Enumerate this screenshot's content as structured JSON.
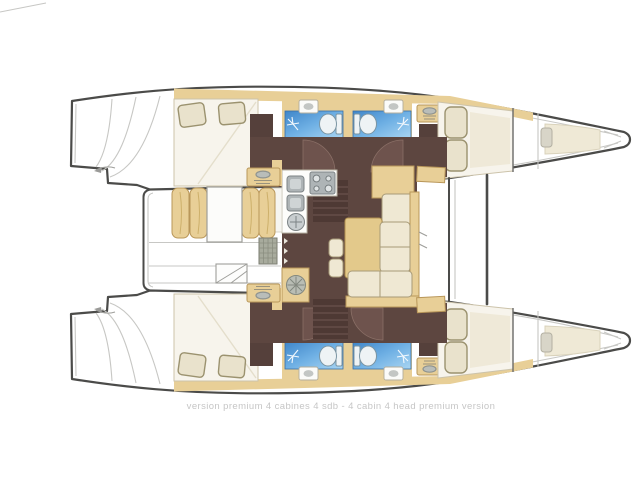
{
  "caption": {
    "text": "version premium 4 cabines 4 sdb - 4 cabin 4 head premium version"
  },
  "plan": {
    "type": "catamaran-deck-plan",
    "cabins": 4,
    "heads": 4,
    "rooms": [
      {
        "name": "port-aft-cabin"
      },
      {
        "name": "port-aft-head"
      },
      {
        "name": "port-forward-head"
      },
      {
        "name": "port-forward-cabin"
      },
      {
        "name": "port-forepeak-berth"
      },
      {
        "name": "starboard-aft-cabin"
      },
      {
        "name": "starboard-aft-head"
      },
      {
        "name": "starboard-forward-head"
      },
      {
        "name": "starboard-forward-cabin"
      },
      {
        "name": "starboard-forepeak-berth"
      },
      {
        "name": "saloon"
      },
      {
        "name": "galley"
      },
      {
        "name": "dinette"
      },
      {
        "name": "cockpit"
      },
      {
        "name": "transom-steps"
      },
      {
        "name": "foredeck"
      }
    ]
  },
  "colors": {
    "outline": "#4b4b49",
    "linelight": "#c7c7c4",
    "linemid": "#9e9e9a",
    "tan": "#e8cf97",
    "tandark": "#b9975a",
    "cream": "#efe8d3",
    "creamdark": "#a79a77",
    "bed": "#f7f4ec",
    "pillow": "#e9e2cc",
    "pillowline": "#9b926f",
    "brown": "#5d4640",
    "brownlight": "#6e534d",
    "wardrobe": "#55403b",
    "stepdark": "#4e3934",
    "blue1": "#3f86c9",
    "blue2": "#a9d5f2",
    "caption": "#c6c6c6"
  }
}
